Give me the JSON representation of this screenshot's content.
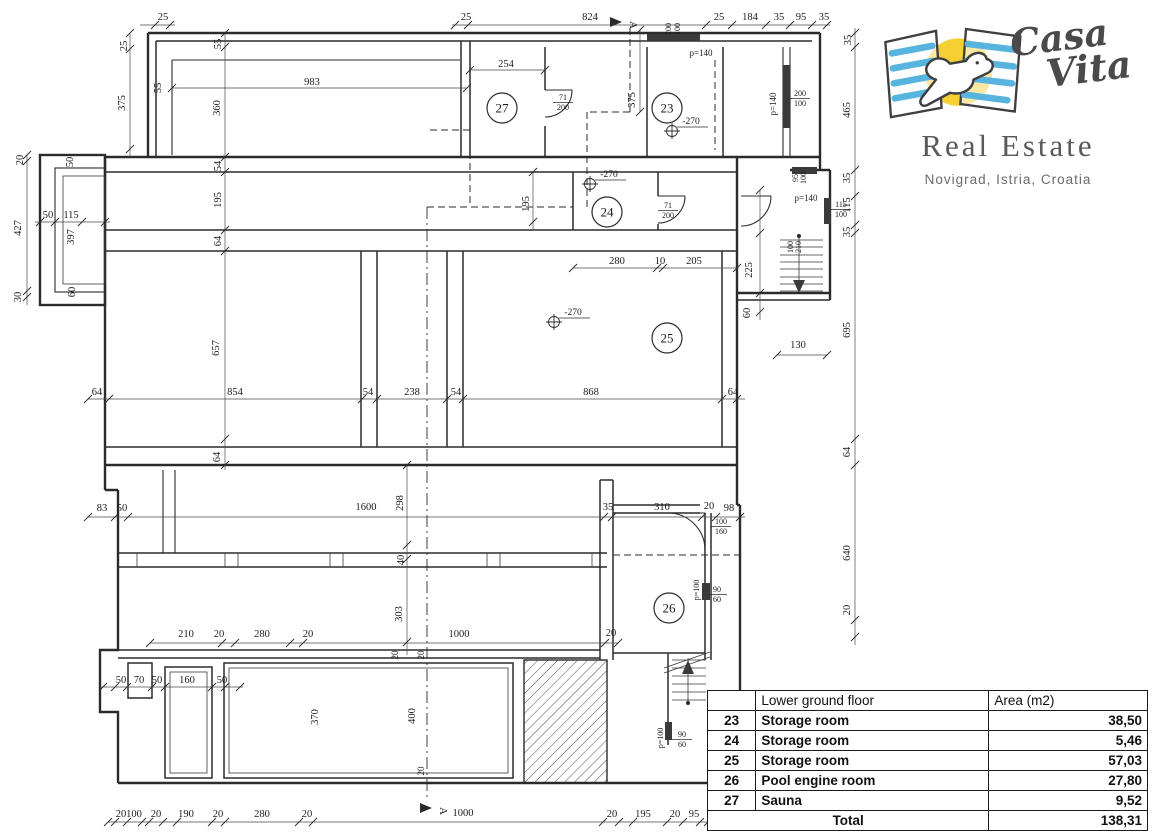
{
  "logo": {
    "brand_line1": "Casa",
    "brand_line2": "Vita",
    "subtitle": "Real Estate",
    "location": "Novigrad, Istria, Croatia",
    "colors": {
      "blue": "#56b4df",
      "yellow": "#f6cf33",
      "ink": "#4a4a4c"
    }
  },
  "table": {
    "header": {
      "col_room": "",
      "col_name": "Lower ground floor",
      "col_area": "Area (m2)"
    },
    "rows": [
      {
        "num": "23",
        "name": "Storage room",
        "area": "38,50"
      },
      {
        "num": "24",
        "name": "Storage room",
        "area": "5,46"
      },
      {
        "num": "25",
        "name": "Storage room",
        "area": "57,03"
      },
      {
        "num": "26",
        "name": "Pool engine room",
        "area": "27,80"
      },
      {
        "num": "27",
        "name": "Sauna",
        "area": "9,52"
      }
    ],
    "total_label": "Total",
    "total_value": "138,31"
  },
  "plan": {
    "rooms": [
      {
        "n": "27",
        "x": 502,
        "y": 108
      },
      {
        "n": "23",
        "x": 667,
        "y": 108
      },
      {
        "n": "24",
        "x": 607,
        "y": 212
      },
      {
        "n": "25",
        "x": 667,
        "y": 338
      },
      {
        "n": "26",
        "x": 669,
        "y": 608
      }
    ],
    "levels": [
      {
        "v": "-270",
        "x": 672,
        "y": 131
      },
      {
        "v": "-270",
        "x": 590,
        "y": 184
      },
      {
        "v": "-270",
        "x": 554,
        "y": 322
      }
    ],
    "sections": [
      {
        "l": "A",
        "x": 622,
        "y": 22
      },
      {
        "l": "A",
        "x": 432,
        "y": 808
      }
    ],
    "fractions": [
      {
        "top": "71",
        "bot": "200",
        "x": 563,
        "y": 96
      },
      {
        "top": "71",
        "bot": "200",
        "x": 668,
        "y": 204
      },
      {
        "top": "200",
        "bot": "100",
        "x": 800,
        "y": 92
      },
      {
        "top": "115",
        "bot": "100",
        "x": 841,
        "y": 203
      },
      {
        "top": "100",
        "bot": "160",
        "x": 721,
        "y": 520
      },
      {
        "top": "90",
        "bot": "60",
        "x": 717,
        "y": 588
      },
      {
        "top": "90",
        "bot": "60",
        "x": 682,
        "y": 733
      }
    ],
    "dims": [
      {
        "t": "25",
        "x": 163,
        "y": 20
      },
      {
        "t": "25",
        "x": 466,
        "y": 20
      },
      {
        "t": "824",
        "x": 590,
        "y": 20
      },
      {
        "t": "25",
        "x": 719,
        "y": 20
      },
      {
        "t": "184",
        "x": 750,
        "y": 20
      },
      {
        "t": "35",
        "x": 779,
        "y": 20
      },
      {
        "t": "95",
        "x": 801,
        "y": 20
      },
      {
        "t": "35",
        "x": 824,
        "y": 20
      },
      {
        "t": "983",
        "x": 312,
        "y": 85
      },
      {
        "t": "254",
        "x": 506,
        "y": 67
      },
      {
        "t": "280",
        "x": 617,
        "y": 264
      },
      {
        "t": "10",
        "x": 660,
        "y": 264
      },
      {
        "t": "205",
        "x": 694,
        "y": 264
      },
      {
        "t": "64",
        "x": 97,
        "y": 395
      },
      {
        "t": "854",
        "x": 235,
        "y": 395
      },
      {
        "t": "54",
        "x": 368,
        "y": 395
      },
      {
        "t": "238",
        "x": 412,
        "y": 395
      },
      {
        "t": "54",
        "x": 456,
        "y": 395
      },
      {
        "t": "868",
        "x": 591,
        "y": 395
      },
      {
        "t": "64",
        "x": 733,
        "y": 395
      },
      {
        "t": "130",
        "x": 798,
        "y": 348
      },
      {
        "t": "50",
        "x": 48,
        "y": 218
      },
      {
        "t": "115",
        "x": 71,
        "y": 218
      },
      {
        "t": "83",
        "x": 102,
        "y": 511
      },
      {
        "t": "50",
        "x": 122,
        "y": 511
      },
      {
        "t": "1600",
        "x": 366,
        "y": 510
      },
      {
        "t": "35",
        "x": 608,
        "y": 510
      },
      {
        "t": "310",
        "x": 662,
        "y": 510
      },
      {
        "t": "20",
        "x": 709,
        "y": 509
      },
      {
        "t": "98",
        "x": 729,
        "y": 511
      },
      {
        "t": "210",
        "x": 186,
        "y": 637
      },
      {
        "t": "20",
        "x": 219,
        "y": 637
      },
      {
        "t": "280",
        "x": 262,
        "y": 637
      },
      {
        "t": "20",
        "x": 308,
        "y": 637
      },
      {
        "t": "1000",
        "x": 459,
        "y": 637
      },
      {
        "t": "20",
        "x": 611,
        "y": 636
      },
      {
        "t": "50",
        "x": 121,
        "y": 683
      },
      {
        "t": "70",
        "x": 139,
        "y": 683
      },
      {
        "t": "50",
        "x": 157,
        "y": 683
      },
      {
        "t": "160",
        "x": 187,
        "y": 683
      },
      {
        "t": "50",
        "x": 222,
        "y": 683
      },
      {
        "t": "20",
        "x": 121,
        "y": 817
      },
      {
        "t": "100",
        "x": 134,
        "y": 817
      },
      {
        "t": "20",
        "x": 156,
        "y": 817
      },
      {
        "t": "190",
        "x": 186,
        "y": 817
      },
      {
        "t": "20",
        "x": 218,
        "y": 817
      },
      {
        "t": "280",
        "x": 262,
        "y": 817
      },
      {
        "t": "20",
        "x": 307,
        "y": 817
      },
      {
        "t": "1000",
        "x": 463,
        "y": 816
      },
      {
        "t": "20",
        "x": 612,
        "y": 817
      },
      {
        "t": "195",
        "x": 643,
        "y": 817
      },
      {
        "t": "20",
        "x": 675,
        "y": 817
      },
      {
        "t": "95",
        "x": 694,
        "y": 817
      },
      {
        "t": "p=140",
        "x": 701,
        "y": 56,
        "s": 9
      },
      {
        "t": "p=140",
        "x": 806,
        "y": 201,
        "s": 9
      },
      {
        "t": "25",
        "x": 127,
        "y": 46,
        "r": -90
      },
      {
        "t": "375",
        "x": 125,
        "y": 103,
        "r": -90
      },
      {
        "t": "55",
        "x": 161,
        "y": 88,
        "r": -90
      },
      {
        "t": "55",
        "x": 221,
        "y": 44,
        "r": -90
      },
      {
        "t": "360",
        "x": 220,
        "y": 108,
        "r": -90
      },
      {
        "t": "375",
        "x": 635,
        "y": 100,
        "r": -90
      },
      {
        "t": "54",
        "x": 221,
        "y": 166,
        "r": -90
      },
      {
        "t": "195",
        "x": 221,
        "y": 200,
        "r": -90
      },
      {
        "t": "64",
        "x": 221,
        "y": 241,
        "r": -90
      },
      {
        "t": "195",
        "x": 529,
        "y": 204,
        "r": -90
      },
      {
        "t": "657",
        "x": 219,
        "y": 348,
        "r": -90
      },
      {
        "t": "64",
        "x": 220,
        "y": 457,
        "r": -90
      },
      {
        "t": "20",
        "x": 23,
        "y": 160,
        "r": -90
      },
      {
        "t": "427",
        "x": 21,
        "y": 228,
        "r": -90
      },
      {
        "t": "30",
        "x": 21,
        "y": 297,
        "r": -90
      },
      {
        "t": "50",
        "x": 73,
        "y": 162,
        "r": -90
      },
      {
        "t": "397",
        "x": 74,
        "y": 237,
        "r": -90
      },
      {
        "t": "60",
        "x": 75,
        "y": 292,
        "r": -90
      },
      {
        "t": "225",
        "x": 752,
        "y": 270,
        "r": -90
      },
      {
        "t": "60",
        "x": 750,
        "y": 313,
        "r": -90
      },
      {
        "t": "35",
        "x": 851,
        "y": 40,
        "r": -90
      },
      {
        "t": "465",
        "x": 850,
        "y": 110,
        "r": -90
      },
      {
        "t": "35",
        "x": 850,
        "y": 178,
        "r": -90
      },
      {
        "t": "115",
        "x": 850,
        "y": 205,
        "r": -90
      },
      {
        "t": "35",
        "x": 850,
        "y": 232,
        "r": -90
      },
      {
        "t": "695",
        "x": 850,
        "y": 330,
        "r": -90
      },
      {
        "t": "64",
        "x": 850,
        "y": 452,
        "r": -90
      },
      {
        "t": "640",
        "x": 850,
        "y": 553,
        "r": -90
      },
      {
        "t": "20",
        "x": 850,
        "y": 610,
        "r": -90
      },
      {
        "t": "298",
        "x": 403,
        "y": 503,
        "r": -90
      },
      {
        "t": "40",
        "x": 404,
        "y": 560,
        "r": -90
      },
      {
        "t": "303",
        "x": 402,
        "y": 614,
        "r": -90
      },
      {
        "t": "370",
        "x": 318,
        "y": 717,
        "r": -90
      },
      {
        "t": "400",
        "x": 415,
        "y": 716,
        "r": -90
      },
      {
        "t": "20",
        "x": 398,
        "y": 655,
        "r": -90,
        "s": 9
      },
      {
        "t": "20",
        "x": 424,
        "y": 655,
        "r": -90,
        "s": 9
      },
      {
        "t": "20",
        "x": 424,
        "y": 771,
        "r": -90,
        "s": 9
      },
      {
        "t": "p=140",
        "x": 776,
        "y": 104,
        "r": -90,
        "s": 9
      },
      {
        "t": "p=100",
        "x": 699,
        "y": 590,
        "r": -90,
        "s": 8
      },
      {
        "t": "p=100",
        "x": 663,
        "y": 738,
        "r": -90,
        "s": 8
      },
      {
        "t": "200",
        "x": 671,
        "y": 29,
        "r": -90,
        "s": 8
      },
      {
        "t": "100",
        "x": 680,
        "y": 29,
        "r": -90,
        "s": 8
      },
      {
        "t": "95",
        "x": 798,
        "y": 178,
        "r": -90,
        "s": 8
      },
      {
        "t": "100",
        "x": 806,
        "y": 178,
        "r": -90,
        "s": 8
      },
      {
        "t": "100",
        "x": 793,
        "y": 247,
        "r": -90,
        "s": 8
      },
      {
        "t": "210",
        "x": 801,
        "y": 247,
        "r": -90,
        "s": 8
      }
    ]
  }
}
